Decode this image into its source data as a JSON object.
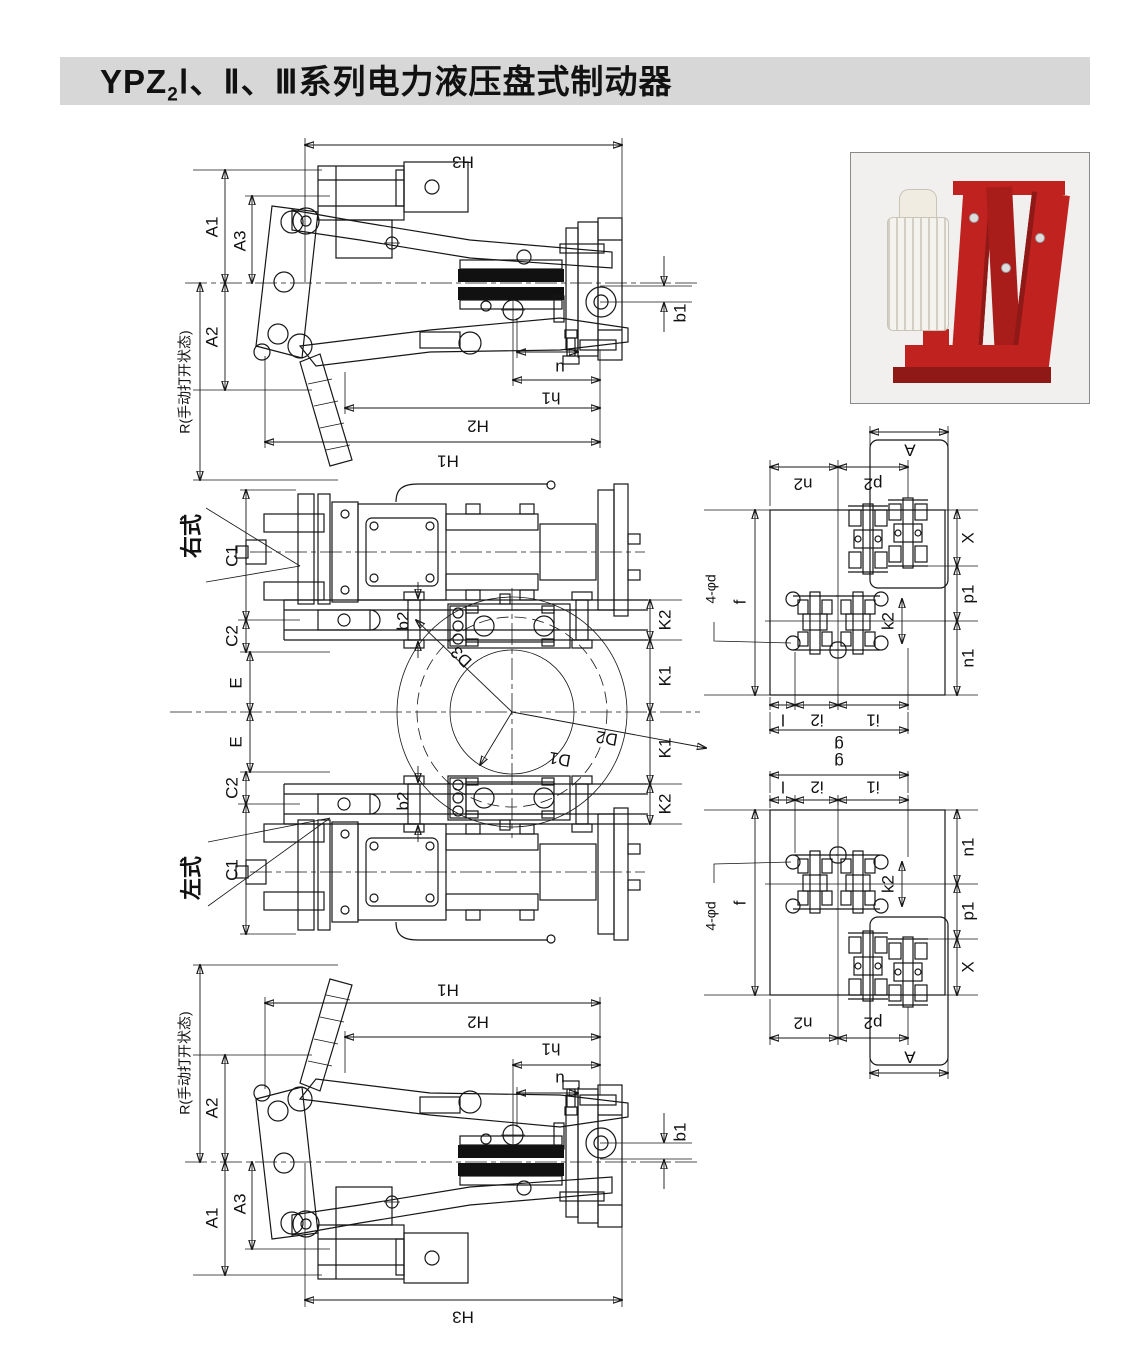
{
  "title": {
    "prefix": "YPZ",
    "subscript": "2",
    "suffix": "Ⅰ、Ⅱ、Ⅲ系列电力液压盘式制动器"
  },
  "colors": {
    "title_bg": "#d7d7d7",
    "ink": "#161616",
    "paper": "#ffffff",
    "photo_bg": "#f1f0ee",
    "photo_border": "#8a8a8a",
    "brake_red": "#bf221f",
    "brake_red_dark": "#8e1916",
    "thruster_white": "#f5f3ee"
  },
  "labels": {
    "H1": "H1",
    "H2": "H2",
    "H3": "H3",
    "h1": "h1",
    "u": "u",
    "b1": "b1",
    "A1": "A1",
    "A2": "A2",
    "A3": "A3",
    "R": "R(手动打开状态)",
    "C1": "C1",
    "C2": "C2",
    "E": "E",
    "b2": "b2",
    "K1": "K1",
    "K2": "K2",
    "D1": "D1",
    "D2": "D2",
    "D3": "D3",
    "right_type": "右式",
    "left_type": "左式",
    "f": "f",
    "phi_d": "4-φd",
    "n1": "n1",
    "n2": "n2",
    "p1": "p1",
    "p2": "p2",
    "A": "A",
    "X": "X",
    "k2": "k2",
    "l": "l",
    "i1": "i1",
    "i2": "i2",
    "g": "g"
  }
}
